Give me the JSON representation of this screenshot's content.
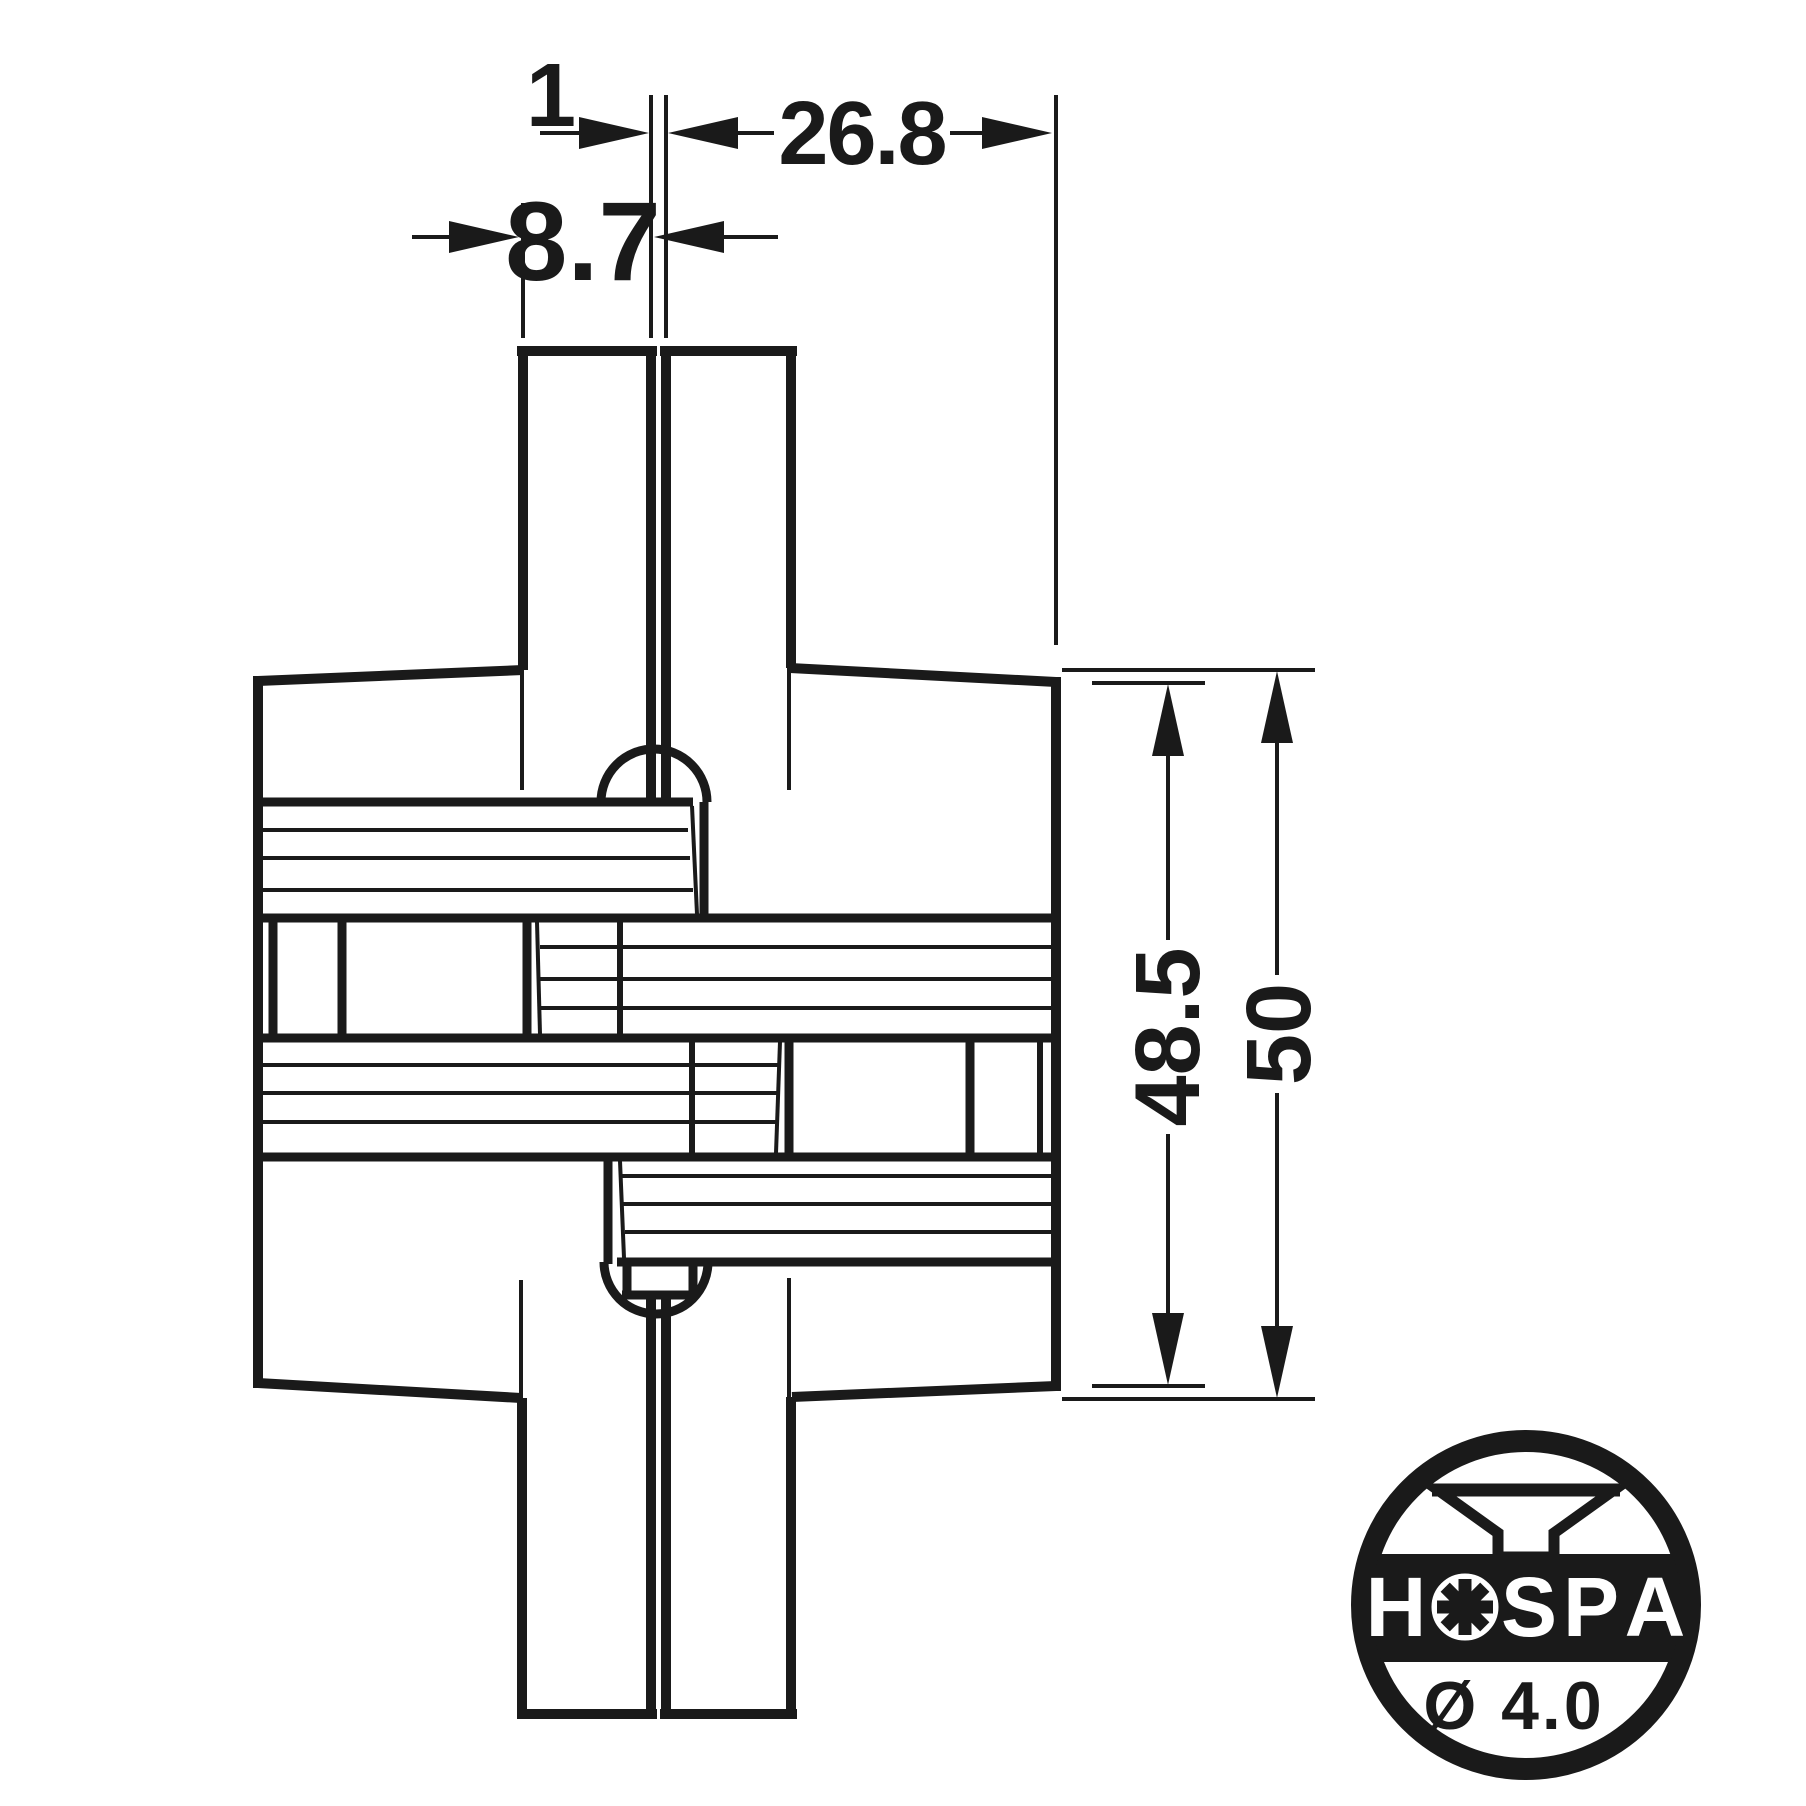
{
  "dimensions": {
    "gap": "1",
    "fitting_width": "26.8",
    "panel_thickness": "8.7",
    "body_height": "48.5",
    "overall_height": "50"
  },
  "logo": {
    "brand": "HOSPA",
    "letters": [
      "H",
      "S",
      "P",
      "A"
    ],
    "screw_diameter": "Ø 4.0"
  },
  "colors": {
    "ink": "#1a1a1a",
    "background": "#ffffff"
  }
}
